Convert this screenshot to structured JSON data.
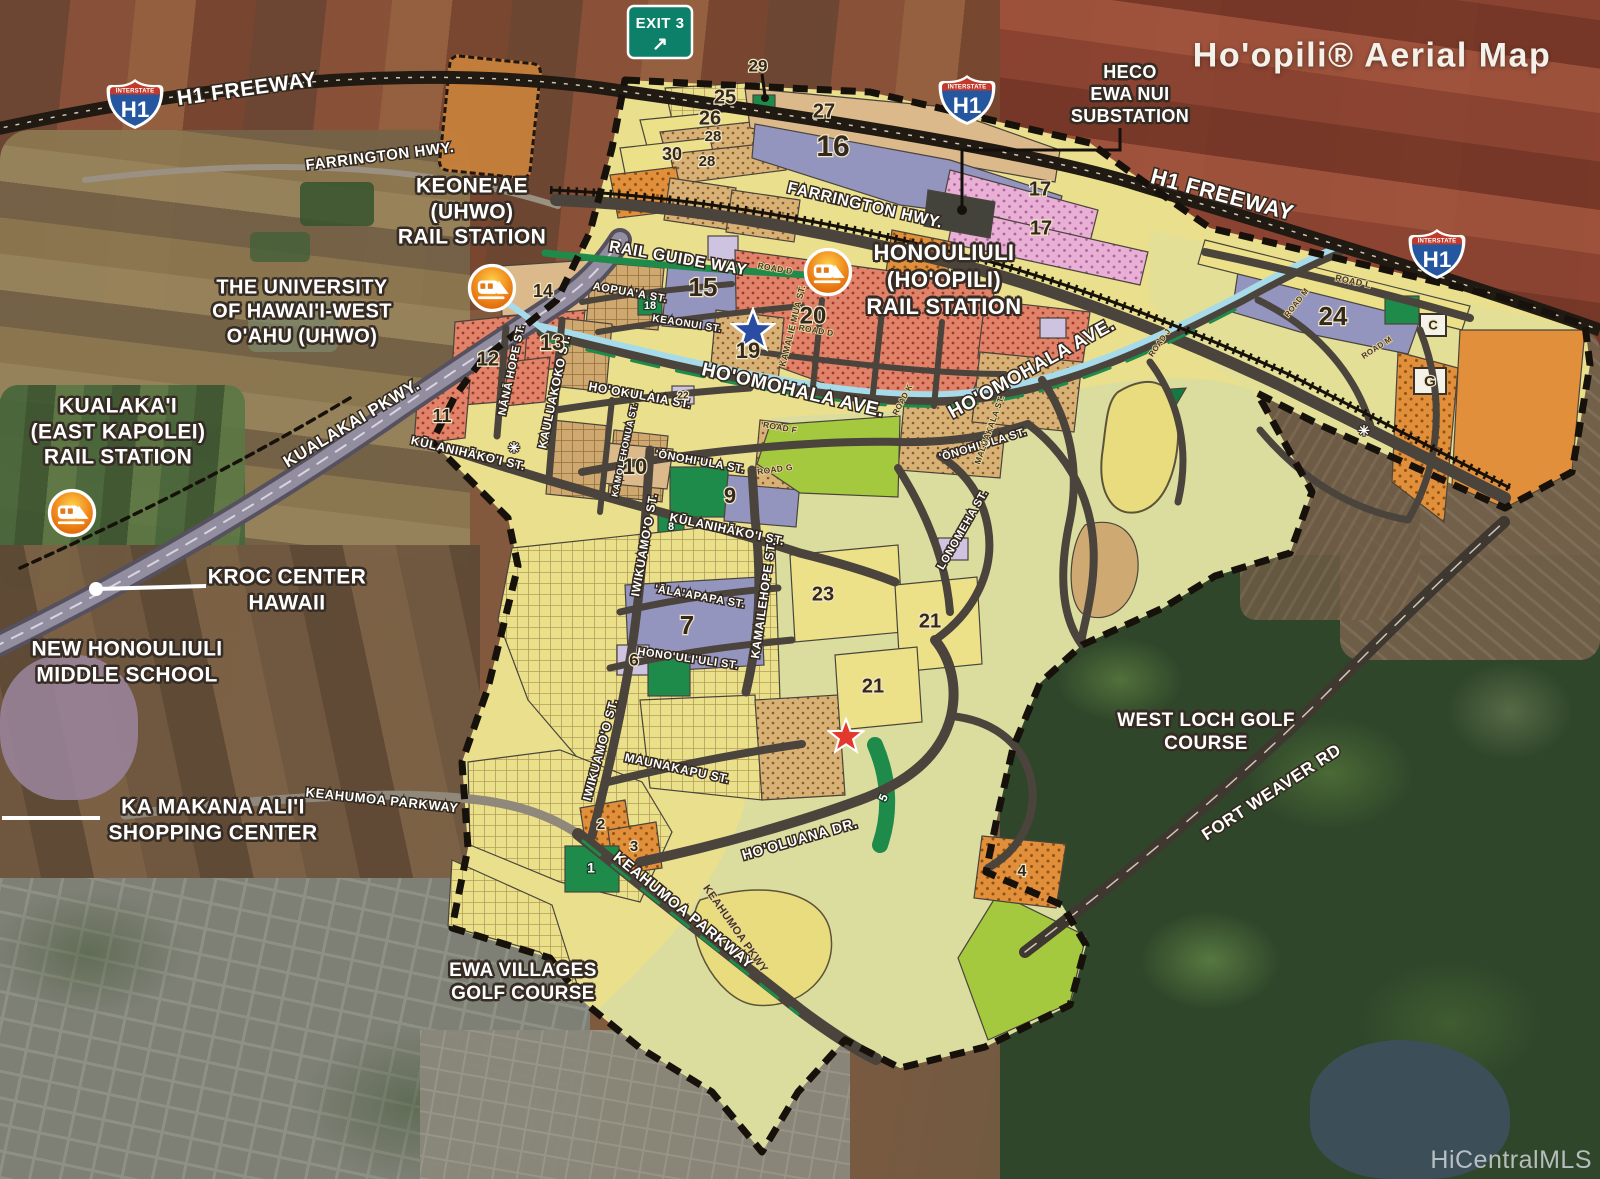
{
  "title": "Ho'opili® Aerial Map",
  "watermark": "HiCentralMLS",
  "exit_sign": {
    "label": "EXIT 3",
    "arrow": "↗"
  },
  "shield": {
    "top": "INTERSTATE",
    "number": "H1"
  },
  "landmarks": [
    {
      "id": "keoneae-rail-station",
      "text": "KEONE'AE\n(UHWO)\nRAIL STATION",
      "x": 472,
      "y": 212,
      "s": 21
    },
    {
      "id": "university-of-hawaii-west-oahu",
      "text": "THE UNIVERSITY\nOF HAWAI'I-WEST\nO'AHU (UHWO)",
      "x": 302,
      "y": 312,
      "s": 20
    },
    {
      "id": "kualakai-rail-station",
      "text": "KUALAKA'I\n(EAST KAPOLEI)\nRAIL STATION",
      "x": 118,
      "y": 432,
      "s": 21
    },
    {
      "id": "kroc-center-hawaii",
      "text": "KROC CENTER\nHAWAII",
      "x": 287,
      "y": 590,
      "s": 21
    },
    {
      "id": "new-honouliuli-middle-school",
      "text": "NEW HONOULIULI\nMIDDLE SCHOOL",
      "x": 127,
      "y": 662,
      "s": 21
    },
    {
      "id": "ka-makana-alii-shopping-center",
      "text": "KA MAKANA ALI'I\nSHOPPING CENTER",
      "x": 213,
      "y": 820,
      "s": 21
    },
    {
      "id": "ewa-villages-golf-course",
      "text": "EWA VILLAGES\nGOLF COURSE",
      "x": 523,
      "y": 982,
      "s": 19
    },
    {
      "id": "west-loch-golf-course",
      "text": "WEST LOCH GOLF\nCOURSE",
      "x": 1206,
      "y": 732,
      "s": 19
    },
    {
      "id": "honouliuli-hoopili-rail-station",
      "text": "HONOULIULI\n(HO'OPILI)\nRAIL STATION",
      "x": 944,
      "y": 280,
      "s": 22
    },
    {
      "id": "heco-ewa-nui-substation",
      "text": "HECO\nEWA NUI\nSUBSTATION",
      "x": 1130,
      "y": 95,
      "s": 18
    }
  ],
  "street_labels": [
    {
      "t": "H1 FREEWAY",
      "x": 247,
      "y": 90,
      "r": -8,
      "s": 21
    },
    {
      "t": "FARRINGTON HWY.",
      "x": 380,
      "y": 157,
      "r": -7,
      "s": 15
    },
    {
      "t": "H1 FREEWAY",
      "x": 1222,
      "y": 196,
      "r": 15,
      "s": 22
    },
    {
      "t": "FARRINGTON HWY.",
      "x": 865,
      "y": 206,
      "r": 13,
      "s": 16
    },
    {
      "t": "RAIL GUIDE WAY",
      "x": 678,
      "y": 259,
      "r": 10,
      "s": 16
    },
    {
      "t": "AOPUA'A ST.",
      "x": 630,
      "y": 293,
      "r": 10,
      "s": 11
    },
    {
      "t": "KEAONUI ST.",
      "x": 687,
      "y": 324,
      "r": 9,
      "s": 10
    },
    {
      "t": "HO'OMOHALA AVE.",
      "x": 793,
      "y": 391,
      "r": 13,
      "s": 19
    },
    {
      "t": "HO'OMOHALA AVE.",
      "x": 1032,
      "y": 369,
      "r": -29,
      "s": 19
    },
    {
      "t": "KUALAKAI PKWY.",
      "x": 352,
      "y": 424,
      "r": -31,
      "s": 17
    },
    {
      "t": "NĀNĀ HOPE ST.",
      "x": 512,
      "y": 370,
      "r": -78,
      "s": 11
    },
    {
      "t": "KAULUAKOKO ST.",
      "x": 555,
      "y": 392,
      "r": -78,
      "s": 12
    },
    {
      "t": "KŪLANIHĀKO'I ST.",
      "x": 468,
      "y": 454,
      "r": 13,
      "s": 12
    },
    {
      "t": "HO'OKULAIA ST.",
      "x": 640,
      "y": 396,
      "r": 10,
      "s": 12
    },
    {
      "t": "KAMOLEHONUA ST.",
      "x": 625,
      "y": 450,
      "r": -78,
      "s": 9
    },
    {
      "t": "'ŌNOHI'ULA ST.",
      "x": 700,
      "y": 462,
      "r": 10,
      "s": 11
    },
    {
      "t": "'ŌNOHI'ULA ST.",
      "x": 983,
      "y": 445,
      "r": -17,
      "s": 11
    },
    {
      "t": "KŪLANIHĀKO'I ST.",
      "x": 727,
      "y": 530,
      "r": 12,
      "s": 12
    },
    {
      "t": "IWIKUAMO'O ST.",
      "x": 645,
      "y": 545,
      "r": -80,
      "s": 12
    },
    {
      "t": "'ĀLA'APAPA ST.",
      "x": 700,
      "y": 597,
      "r": 10,
      "s": 11
    },
    {
      "t": "HONO'ULI'ULI ST.",
      "x": 688,
      "y": 659,
      "r": 8,
      "s": 11
    },
    {
      "t": "KAMAILEHOPE ST.",
      "x": 764,
      "y": 600,
      "r": -82,
      "s": 12
    },
    {
      "t": "LONOMEHA ST.",
      "x": 963,
      "y": 530,
      "r": -60,
      "s": 11
    },
    {
      "t": "IWIKUAMO'O ST.",
      "x": 601,
      "y": 750,
      "r": -75,
      "s": 12
    },
    {
      "t": "MAUNAKAPU ST.",
      "x": 677,
      "y": 769,
      "r": 12,
      "s": 12
    },
    {
      "t": "HO'OLUANA DR.",
      "x": 800,
      "y": 840,
      "r": -16,
      "s": 14
    },
    {
      "t": "KEAHUMOA PARKWAY",
      "x": 382,
      "y": 801,
      "r": 6,
      "s": 13
    },
    {
      "t": "KEAHUMOA PARKWAY",
      "x": 683,
      "y": 911,
      "r": 39,
      "s": 15
    },
    {
      "t": "FORT WEAVER RD",
      "x": 1272,
      "y": 793,
      "r": -33,
      "s": 17
    }
  ],
  "road_labels": [
    {
      "t": "ROAD D",
      "x": 775,
      "y": 269,
      "r": 10,
      "s": 8.5
    },
    {
      "t": "ROAD D",
      "x": 816,
      "y": 331,
      "r": 10,
      "s": 8.5
    },
    {
      "t": "ROAD F",
      "x": 780,
      "y": 428,
      "r": 10,
      "s": 8.5
    },
    {
      "t": "ROAD G",
      "x": 775,
      "y": 470,
      "r": -8,
      "s": 8.5
    },
    {
      "t": "ROAD K",
      "x": 903,
      "y": 400,
      "r": -62,
      "s": 8
    },
    {
      "t": "KAMALIE MUA ST.",
      "x": 793,
      "y": 326,
      "r": -76,
      "s": 9
    },
    {
      "t": "MALUAKALA ST.",
      "x": 990,
      "y": 430,
      "r": -70,
      "s": 8.5
    },
    {
      "t": "ROAD L",
      "x": 1353,
      "y": 282,
      "r": 12,
      "s": 9
    },
    {
      "t": "ROAD M",
      "x": 1297,
      "y": 303,
      "r": -52,
      "s": 8
    },
    {
      "t": "ROAD M",
      "x": 1377,
      "y": 348,
      "r": -33,
      "s": 8
    },
    {
      "t": "ROAD J",
      "x": 1160,
      "y": 343,
      "r": -55,
      "s": 8
    },
    {
      "t": "KEAHUMOA PKWY",
      "x": 735,
      "y": 929,
      "r": 55,
      "s": 11
    }
  ],
  "parcel_labels": [
    {
      "t": "25",
      "x": 725,
      "y": 98,
      "s": 20
    },
    {
      "t": "26",
      "x": 710,
      "y": 119,
      "s": 20
    },
    {
      "t": "28",
      "x": 713,
      "y": 137,
      "s": 15
    },
    {
      "t": "30",
      "x": 672,
      "y": 155,
      "s": 18
    },
    {
      "t": "28",
      "x": 707,
      "y": 162,
      "s": 15
    },
    {
      "t": "27",
      "x": 824,
      "y": 112,
      "s": 20
    },
    {
      "t": "16",
      "x": 833,
      "y": 148,
      "s": 30
    },
    {
      "t": "29",
      "x": 758,
      "y": 67,
      "s": 17
    },
    {
      "t": "17",
      "x": 1040,
      "y": 190,
      "s": 20
    },
    {
      "t": "17",
      "x": 1041,
      "y": 229,
      "s": 20
    },
    {
      "t": "14",
      "x": 543,
      "y": 292,
      "s": 18
    },
    {
      "t": "15",
      "x": 703,
      "y": 289,
      "s": 26
    },
    {
      "t": "18",
      "x": 650,
      "y": 306,
      "s": 11,
      "w": true
    },
    {
      "t": "12",
      "x": 488,
      "y": 360,
      "s": 20
    },
    {
      "t": "13",
      "x": 552,
      "y": 344,
      "s": 22
    },
    {
      "t": "11",
      "x": 442,
      "y": 417,
      "s": 18
    },
    {
      "t": "19",
      "x": 748,
      "y": 352,
      "s": 22
    },
    {
      "t": "20",
      "x": 813,
      "y": 317,
      "s": 24
    },
    {
      "t": "22",
      "x": 683,
      "y": 396,
      "s": 10
    },
    {
      "t": "10",
      "x": 635,
      "y": 468,
      "s": 22
    },
    {
      "t": "9",
      "x": 730,
      "y": 497,
      "s": 22
    },
    {
      "t": "8",
      "x": 671,
      "y": 527,
      "s": 11,
      "w": true
    },
    {
      "t": "7",
      "x": 687,
      "y": 627,
      "s": 26
    },
    {
      "t": "6",
      "x": 634,
      "y": 661,
      "s": 17
    },
    {
      "t": "23",
      "x": 823,
      "y": 595,
      "s": 20
    },
    {
      "t": "21",
      "x": 930,
      "y": 622,
      "s": 20
    },
    {
      "t": "21",
      "x": 873,
      "y": 687,
      "s": 20
    },
    {
      "t": "24",
      "x": 1333,
      "y": 318,
      "s": 26
    },
    {
      "t": "C",
      "x": 1433,
      "y": 326,
      "s": 13
    },
    {
      "t": "G",
      "x": 1430,
      "y": 382,
      "s": 15
    },
    {
      "t": "5",
      "x": 884,
      "y": 798,
      "s": 12,
      "w": true,
      "r": -65
    },
    {
      "t": "2",
      "x": 601,
      "y": 825,
      "s": 15
    },
    {
      "t": "3",
      "x": 634,
      "y": 847,
      "s": 15
    },
    {
      "t": "1",
      "x": 591,
      "y": 869,
      "s": 14,
      "w": true
    },
    {
      "t": "4",
      "x": 1022,
      "y": 872,
      "s": 16
    }
  ],
  "markers": {
    "asterisk": "✳",
    "asterisk_positions": [
      {
        "x": 514,
        "y": 449
      },
      {
        "x": 1364,
        "y": 432
      }
    ]
  },
  "stations": [
    {
      "x": 492,
      "y": 288
    },
    {
      "x": 828,
      "y": 272
    },
    {
      "x": 72,
      "y": 513
    }
  ],
  "stars": [
    {
      "x": 753,
      "y": 330,
      "size": 46,
      "color": "#2b4da1"
    },
    {
      "x": 846,
      "y": 736,
      "size": 38,
      "color": "#e2392c"
    }
  ]
}
